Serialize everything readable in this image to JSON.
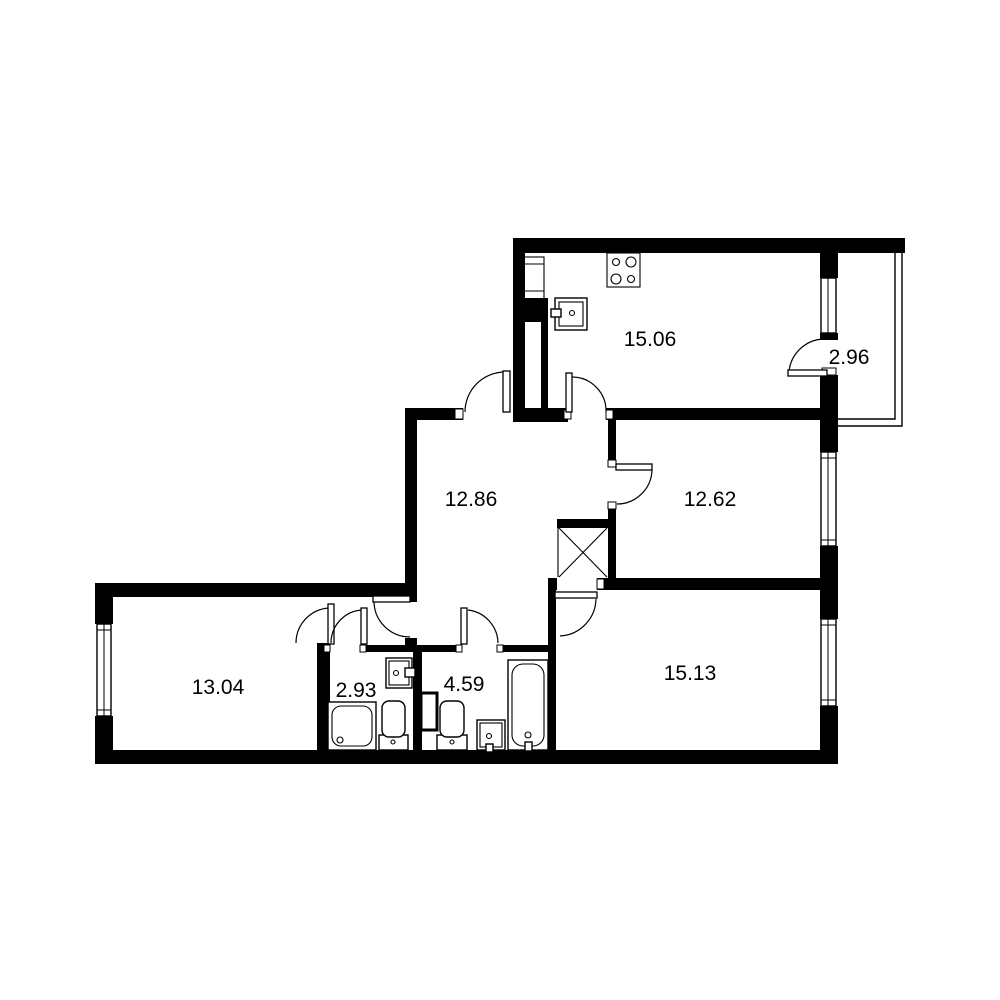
{
  "colors": {
    "wall": "#000000",
    "background": "#ffffff"
  },
  "rooms": [
    {
      "id": "kitchen",
      "area": "15.06"
    },
    {
      "id": "balcony",
      "area": "2.96"
    },
    {
      "id": "bedroom-right",
      "area": "12.62"
    },
    {
      "id": "hallway",
      "area": "12.86"
    },
    {
      "id": "bedroom-left",
      "area": "13.04"
    },
    {
      "id": "bathroom",
      "area": "2.93"
    },
    {
      "id": "toilet-room",
      "area": "4.59"
    },
    {
      "id": "living-room",
      "area": "15.13"
    }
  ],
  "fixtures": [
    "stove",
    "kitchen-sink",
    "tall-cabinet",
    "shower-tray",
    "toilet",
    "wall-sink",
    "toilet",
    "washbasin",
    "bathtub",
    "vent-shaft",
    "duct-shaft"
  ]
}
